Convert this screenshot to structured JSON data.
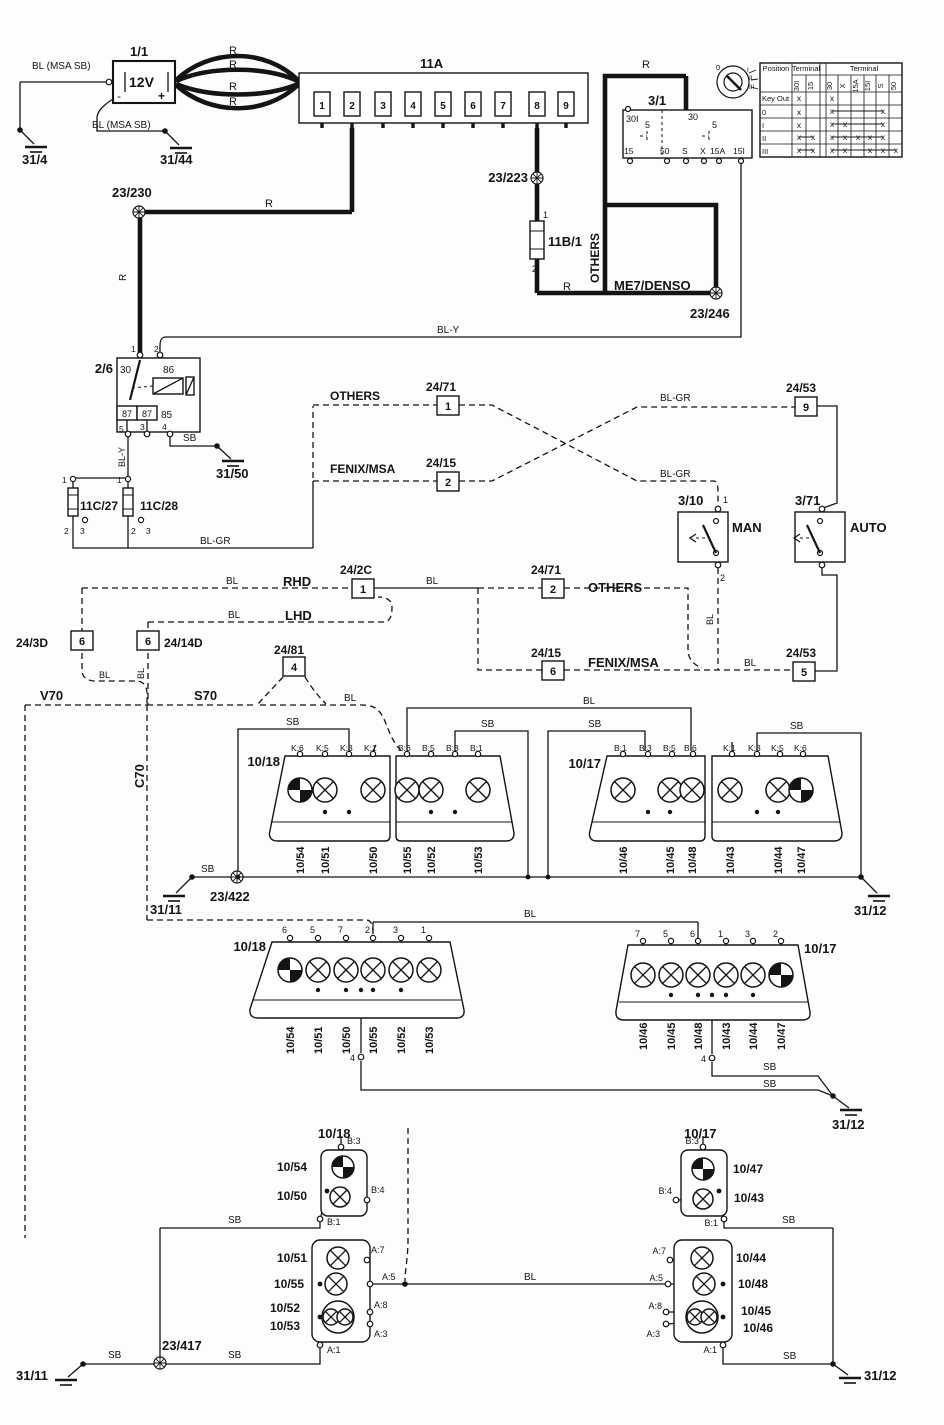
{
  "diagram": {
    "wires": {
      "r": "R",
      "sb": "SB",
      "bl": "BL",
      "bl_y": "BL-Y",
      "bl_gr": "BL-GR",
      "bl_msa_sb": "BL (MSA SB)"
    },
    "battery": {
      "id": "1/1",
      "voltage": "12V",
      "plus": "+",
      "minus": "-"
    },
    "fusebox": {
      "id": "11A",
      "fuses": [
        "1",
        "2",
        "3",
        "4",
        "5",
        "6",
        "7",
        "8",
        "9"
      ]
    },
    "fuse_11b1": {
      "id": "11B/1"
    },
    "fuses_11c": {
      "left": "11C/27",
      "right": "11C/28"
    },
    "ignition": {
      "id": "3/1",
      "t_30i": "30I",
      "t_30": "30",
      "t_5": "5",
      "t_15": "15",
      "t_50": "50",
      "t_s": "S",
      "t_x": "X",
      "t_15a": "15A",
      "t_15i": "15I",
      "key": [
        "0",
        "I",
        "II",
        "III"
      ]
    },
    "table": {
      "position": "Position",
      "terminal": "Terminal",
      "left_cols": [
        "30I",
        "15"
      ],
      "right_cols": [
        "30",
        "X",
        "15A",
        "15I",
        "S",
        "50"
      ],
      "rows": [
        {
          "label": "Key Out",
          "left": [
            "x",
            ""
          ],
          "right": [
            "x",
            "",
            "",
            "",
            "",
            ""
          ]
        },
        {
          "label": "0",
          "left": [
            "x",
            ""
          ],
          "right": [
            "x",
            "",
            "",
            "",
            "x",
            ""
          ]
        },
        {
          "label": "I",
          "left": [
            "x",
            ""
          ],
          "right": [
            "x",
            "x",
            "",
            "",
            "x",
            ""
          ]
        },
        {
          "label": "II",
          "left": [
            "x",
            "x"
          ],
          "right": [
            "x",
            "x",
            "x",
            "x",
            "x",
            ""
          ]
        },
        {
          "label": "III",
          "left": [
            "x",
            "x"
          ],
          "right": [
            "x",
            "x",
            "",
            "x",
            "x",
            "x"
          ]
        }
      ]
    },
    "relay": {
      "id": "2/6",
      "t30": "30",
      "t86": "86",
      "t87": "87",
      "t85": "85"
    },
    "pins_num": {
      "n1": "1",
      "n2": "2",
      "n3": "3",
      "n4": "4",
      "n5": "5",
      "n6": "6",
      "n7": "7",
      "n9": "9"
    },
    "grounds": {
      "g31_4": "31/4",
      "g31_44": "31/44",
      "g31_50": "31/50",
      "g31_11": "31/11",
      "g31_12": "31/12"
    },
    "splices": {
      "s23_230": "23/230",
      "s23_223": "23/223",
      "s23_246": "23/246",
      "s23_417": "23/417",
      "s23_422": "23/422"
    },
    "systems": {
      "others": "OTHERS",
      "fenix": "FENIX/MSA",
      "me7": "ME7/DENSO",
      "rhd": "RHD",
      "lhd": "LHD",
      "man": "MAN",
      "auto": "AUTO",
      "v70": "V70",
      "s70": "S70",
      "c70": "C70"
    },
    "switches": {
      "man": "3/10",
      "auto": "3/71"
    },
    "connectors": {
      "c24_71": "24/71",
      "c24_15": "24/15",
      "c24_53": "24/53",
      "c24_2c": "24/2C",
      "c24_3d": "24/3D",
      "c24_14d": "24/14D",
      "c24_81": "24/81"
    },
    "clusters": {
      "left": "10/18",
      "right": "10/17"
    },
    "lamps": {
      "l43": "10/43",
      "l44": "10/44",
      "l45": "10/45",
      "l46": "10/46",
      "l47": "10/47",
      "l48": "10/48",
      "l50": "10/50",
      "l51": "10/51",
      "l52": "10/52",
      "l53": "10/53",
      "l54": "10/54",
      "l55": "10/55"
    },
    "pins": {
      "k1": "K:1",
      "k3": "K:3",
      "k5": "K:5",
      "k6": "K:6",
      "b1": "B:1",
      "b3": "B:3",
      "b4": "B:4",
      "b5": "B:5",
      "b6": "B:6",
      "a1": "A:1",
      "a3": "A:3",
      "a5": "A:5",
      "a7": "A:7",
      "a8": "A:8"
    }
  }
}
